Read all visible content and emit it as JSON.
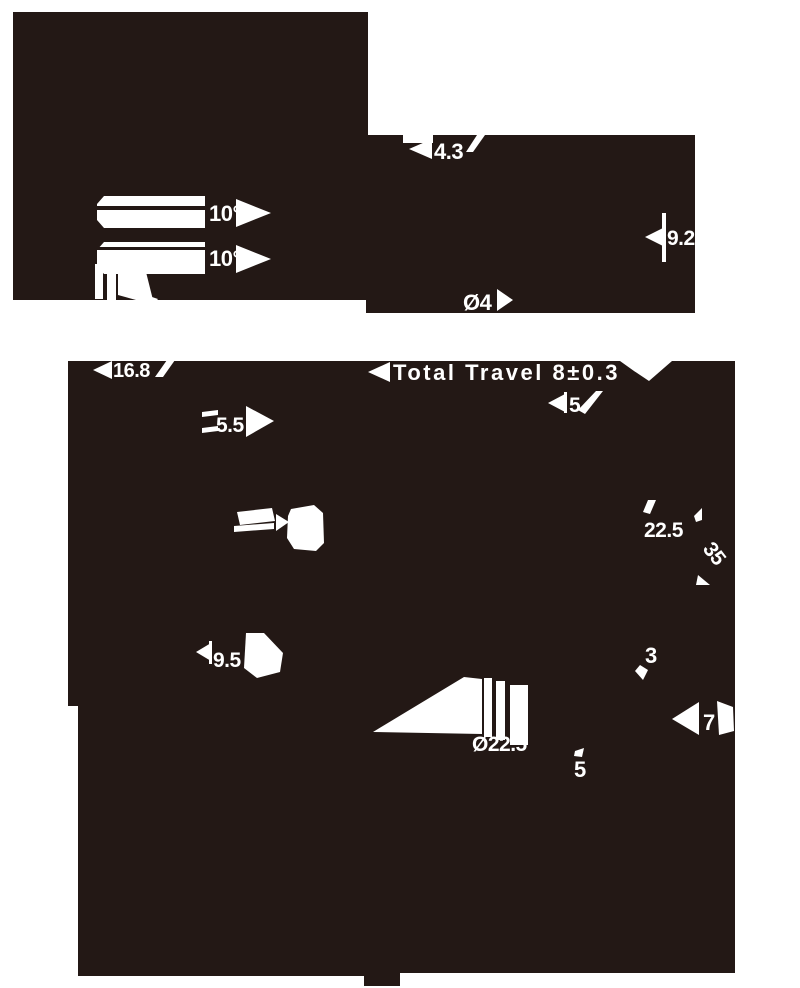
{
  "drawing": {
    "colors": {
      "ink": "#231815",
      "paper": "#ffffff",
      "text": "#ffffff"
    },
    "dims": {
      "angle_top": "10°",
      "angle_bottom": "10°",
      "top_width": "4.3",
      "right_height": "9.2",
      "shaft_dia": "Ø4",
      "body_width": "16.8",
      "total_travel": "Total Travel 8±0.3",
      "upper_offset": "5",
      "tip_width": "5.5",
      "side_depth": "22.5",
      "body_height": "35",
      "step_height": "3",
      "tip_height": "9.5",
      "base_height": "7",
      "flange_dia": "Ø22.5",
      "lower_offset": "5"
    }
  }
}
